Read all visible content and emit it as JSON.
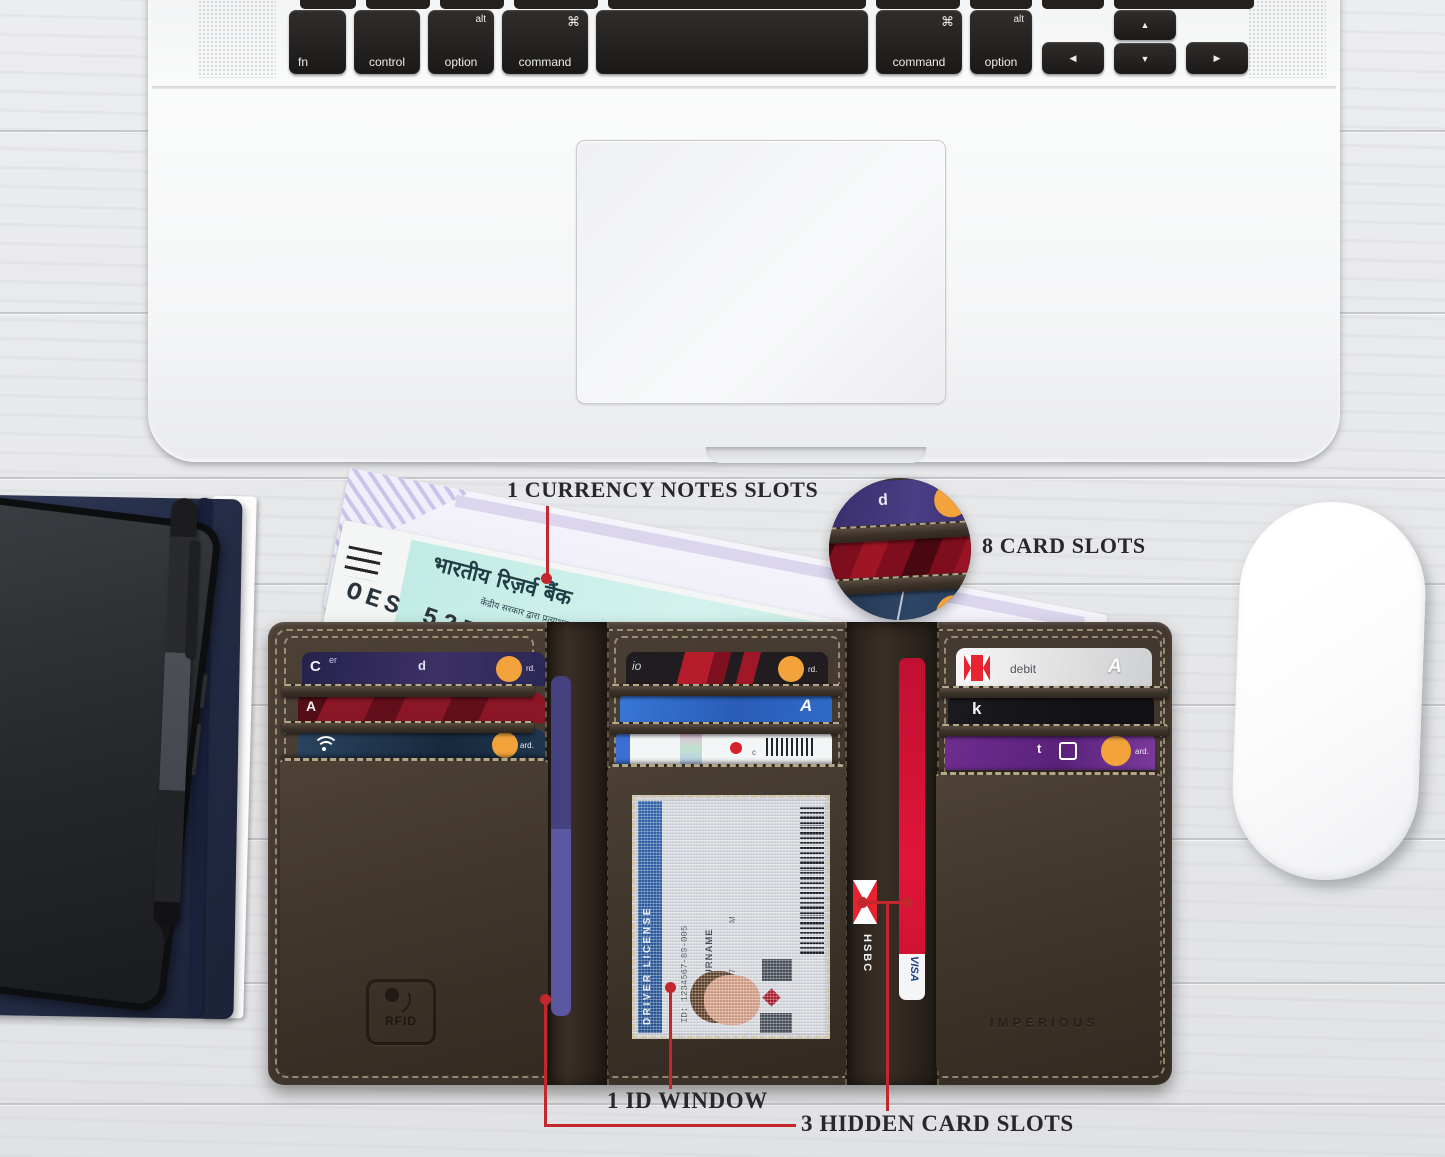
{
  "annotations": {
    "currency_notes": "1 CURRENCY NOTES SLOTS",
    "card_slots": "8 CARD SLOTS",
    "id_window": "1 ID WINDOW",
    "hidden_card_slots": "3 HIDDEN CARD SLOTS"
  },
  "laptop": {
    "keys": {
      "fn": "fn",
      "control": "control",
      "option": "option",
      "alt": "alt",
      "command": "command",
      "cmd_symbol": "⌘",
      "arrow_left": "◀",
      "arrow_up": "▲",
      "arrow_down": "▼",
      "arrow_right": "▶"
    }
  },
  "currency_note": {
    "bank_line": "भारतीय रिज़र्व बैंक",
    "guarantee_line": "केंद्रीय सरकार द्वारा प्रत्याभूत",
    "serial": "OES 527423",
    "denomination_line": "पचास रुपये"
  },
  "wallet": {
    "rfid_stamp": "RFID",
    "brand_stamp": "IMPERIOUS",
    "id_card": {
      "title": "DRIVER LICENSE",
      "id_number": "ID: 1234567-89-005",
      "name": "NAME SURNAME",
      "dob": "24.05.1997",
      "sex": "M"
    },
    "cards": {
      "left1_c": "C",
      "left1_er": "er",
      "left1_d": "d",
      "left1_rd": "rd.",
      "left2_a": "A",
      "left3_ard": "ard.",
      "center1_io": "io",
      "center1_rd": "rd.",
      "center2_a": "A",
      "center3_c": "c",
      "right1_debit": "debit",
      "right1_a": "A",
      "right2_k": "k",
      "right3_t": "t",
      "right3_ard": "ard.",
      "hidden_hsbc": "HSBC",
      "hidden_visa": "VISA",
      "inset_d": "d",
      "inset_o": "o"
    }
  },
  "colors": {
    "annotation_red": "#c1272d",
    "leather": "#46392e",
    "stitch": "#cdbf9d"
  }
}
